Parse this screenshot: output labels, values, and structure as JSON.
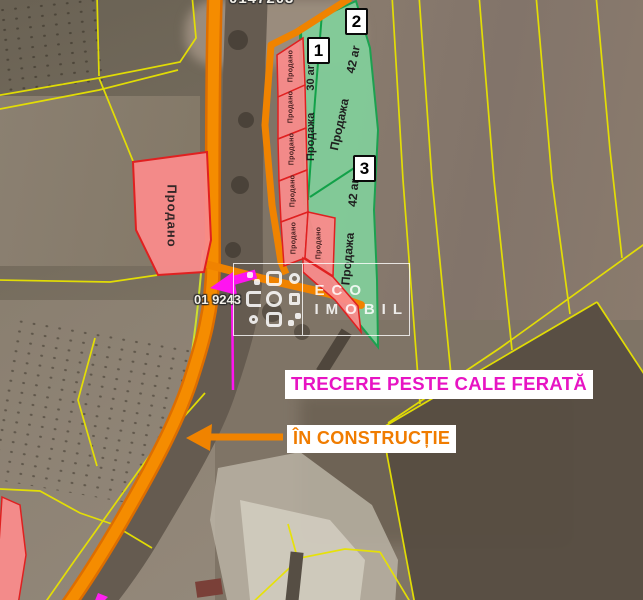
{
  "map": {
    "parcel_codes": {
      "top_partial": "0147203",
      "junction": "01 9243"
    },
    "sold_label": "Продано",
    "sale_parcels": [
      {
        "badge": "1",
        "name": "Продажа",
        "area": "30 ar"
      },
      {
        "badge": "2",
        "name": "Продажа",
        "area": "42 ar"
      },
      {
        "badge": "3",
        "name": "Продажа",
        "area": "42 ar"
      }
    ],
    "annotations": {
      "crossing": "TRECERE PESTE CALE FERATĂ",
      "construction": "ÎN CONSTRUCȚIE"
    },
    "watermark": {
      "line1": "ECO",
      "line2": "IMOBIL"
    },
    "colors": {
      "road_orange": "#f08300",
      "cadastral_yellow": "#e8e300",
      "sold_fill": "#f98b8b",
      "sold_border": "#e02020",
      "sale_fill": "#82cf9b",
      "sale_border": "#14a54e",
      "highlight_magenta": "#ff14f0",
      "crossing_text": "#e714c3",
      "construction_text": "#f07c00"
    }
  }
}
